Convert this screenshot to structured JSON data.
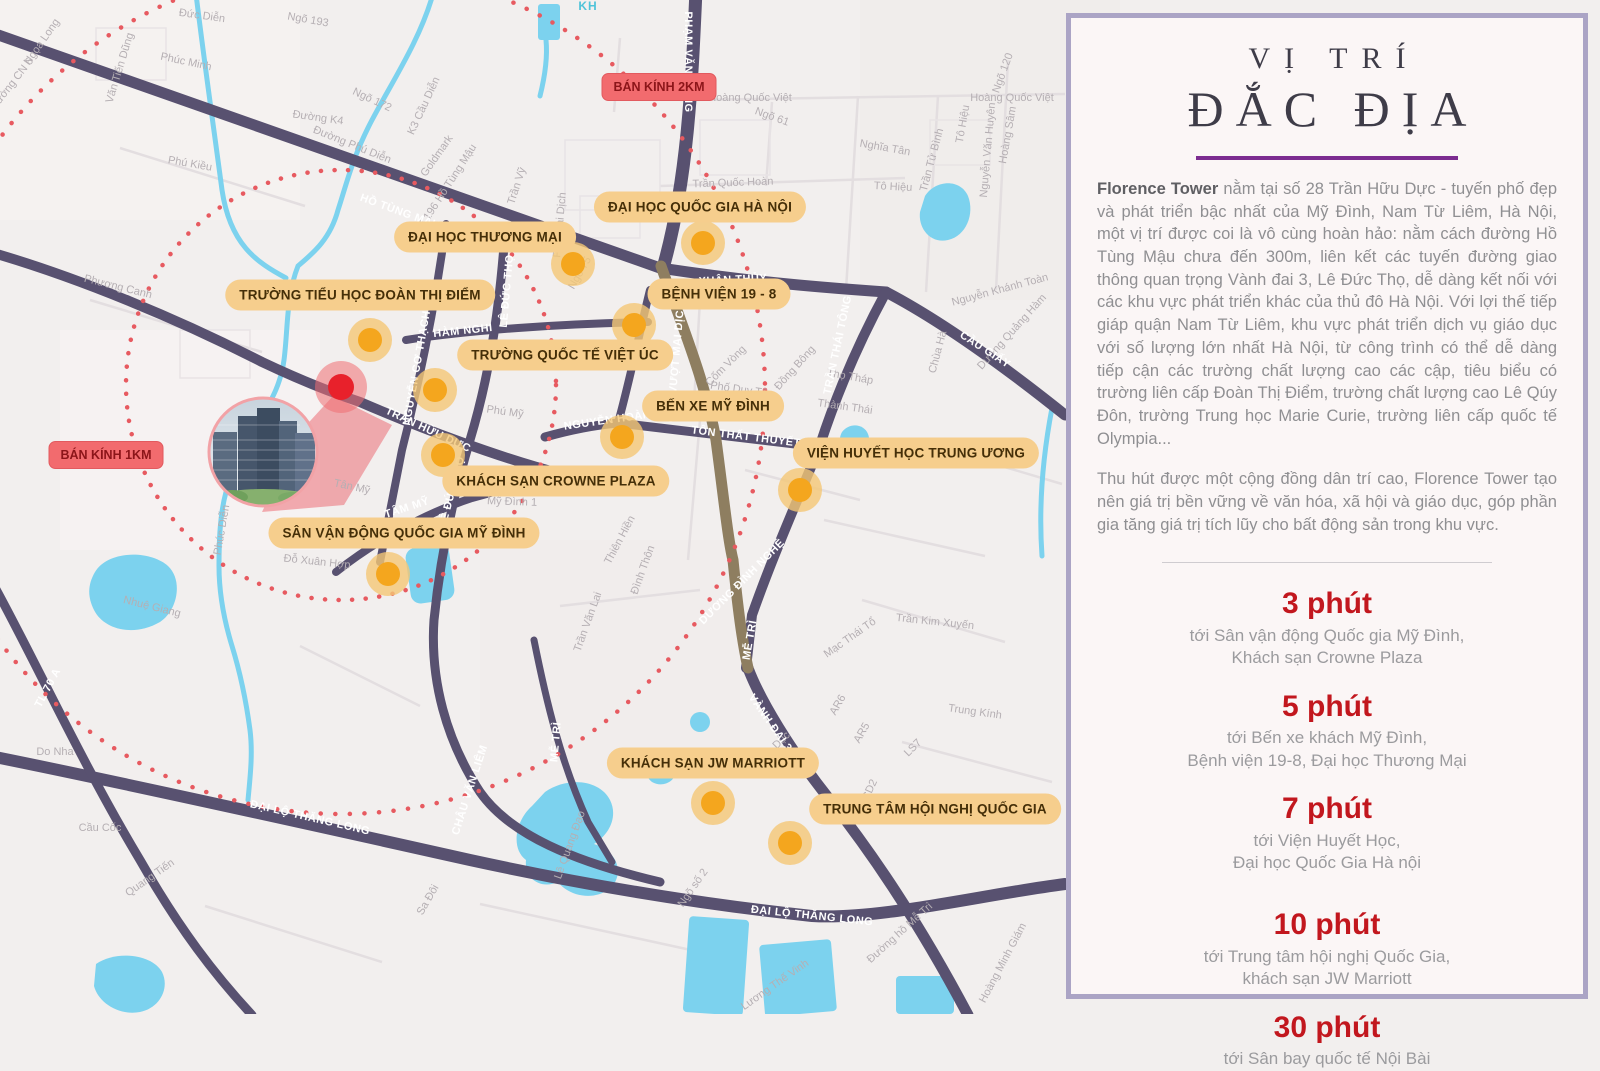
{
  "colors": {
    "road_purple": "#585170",
    "road_brown": "#8E7E60",
    "water": "#7CD2EE",
    "poi_bg": "#F6CE8D",
    "poi_text": "#452F08",
    "radius_bg": "#F26B6E",
    "radius_text": "#8C1519",
    "marker_core": "#F4A61E",
    "marker_halo": "#F4C776",
    "project_red": "#E8212B",
    "dotted_circle": "#E75A60",
    "panel_border": "#ABA4C5",
    "panel_bg": "#FBF6F6",
    "accent_purple": "#7C2C90",
    "time_red": "#C2171E",
    "body_text": "#8F8F92"
  },
  "map": {
    "radius_labels": [
      {
        "t": "BÁN KÍNH 2KM"
      },
      {
        "t": "BÁN KÍNH 1KM"
      }
    ],
    "pois": [
      {
        "t": "ĐẠI HỌC QUỐC GIA HÀ NỘI"
      },
      {
        "t": "ĐẠI HỌC THƯƠNG MẠI"
      },
      {
        "t": "TRƯỜNG TIỂU HỌC ĐOÀN THỊ ĐIỂM"
      },
      {
        "t": "BỆNH VIỆN 19 - 8"
      },
      {
        "t": "TRƯỜNG QUỐC TẾ VIỆT ÚC"
      },
      {
        "t": "BẾN XE MỸ ĐÌNH"
      },
      {
        "t": "KHÁCH SẠN CROWNE PLAZA"
      },
      {
        "t": "VIỆN HUYẾT HỌC TRUNG ƯƠNG"
      },
      {
        "t": "SÂN VẬN ĐỘNG QUỐC GIA MỸ ĐÌNH"
      },
      {
        "t": "KHÁCH SẠN JW MARRIOTT"
      },
      {
        "t": "TRUNG TÂM HỘI NGHỊ QUỐC GIA"
      }
    ],
    "roads_labels": [
      {
        "t": "HỒ TÙNG MẬU"
      },
      {
        "t": "PHẠM VĂN ĐỒNG"
      },
      {
        "t": "XUÂN THỦY"
      },
      {
        "t": "CẦU GIẤY"
      },
      {
        "t": "TRẦN THÁI TÔNG"
      },
      {
        "t": "CẦU VƯỢT MAI DỊCH"
      },
      {
        "t": "TÔN THẤT THUYẾT"
      },
      {
        "t": "LÊ ĐỨC THỌ"
      },
      {
        "t": "LÊ ĐỨC THỌ"
      },
      {
        "t": "TRẦN HỮU DỰC"
      },
      {
        "t": "TÂM MỸ"
      },
      {
        "t": "NGUYỄN CƠ THẠCH"
      },
      {
        "t": "HÀM NGHI"
      },
      {
        "t": "NGUYỄN HOÀNG"
      },
      {
        "t": "ĐẠI LỘ THĂNG LONG"
      },
      {
        "t": "ĐẠI LỘ THĂNG LONG"
      },
      {
        "t": "VÀNH ĐAI 3"
      },
      {
        "t": "MỄ TRÌ"
      },
      {
        "t": "MỄ TRÌ"
      },
      {
        "t": "DƯƠNG ĐÌNH NGHỆ"
      },
      {
        "t": "CHÂU VĂN LIÊM"
      },
      {
        "t": "TL 70 A"
      }
    ],
    "streets": [
      {
        "t": "Ngọa Long"
      },
      {
        "t": "Văn Tiến Dũng"
      },
      {
        "t": "Đức Diễn"
      },
      {
        "t": "Phúc Minh"
      },
      {
        "t": "Ngõ 193"
      },
      {
        "t": "Đường K4"
      },
      {
        "t": "Ngõ 172"
      },
      {
        "t": "Đường Phú Diễn"
      },
      {
        "t": "K3 Cầu Diễn"
      },
      {
        "t": "Phú Kiều"
      },
      {
        "t": "Đường CN 6"
      },
      {
        "t": "Phương Canh"
      },
      {
        "t": "Goldmark"
      },
      {
        "t": "Ngõ 196 Hồ Tùng Mậu"
      },
      {
        "t": "Trần Vỹ"
      },
      {
        "t": "Phố Mai Dịch"
      },
      {
        "t": "Ngõ 75"
      },
      {
        "t": "Hoàng Quốc Việt"
      },
      {
        "t": "Hoàng Quốc Việt"
      },
      {
        "t": "Ngõ 61"
      },
      {
        "t": "Ngõ 120"
      },
      {
        "t": "Trần Quốc Hoàn"
      },
      {
        "t": "Nghĩa Tân"
      },
      {
        "t": "Tô Hiệu"
      },
      {
        "t": "Tô Hiệu"
      },
      {
        "t": "Trần Tử Bình"
      },
      {
        "t": "Nguyễn Văn Huyên"
      },
      {
        "t": "Hoàng Sâm"
      },
      {
        "t": "Nguyễn Khánh Toàn"
      },
      {
        "t": "Dương Quảng Hàm"
      },
      {
        "t": "Chùa Hà"
      },
      {
        "t": "Đồng Bông"
      },
      {
        "t": "Thọ Tháp"
      },
      {
        "t": "Thành Thái"
      },
      {
        "t": "Phố Duy Tân"
      },
      {
        "t": "Cốm Vòng"
      },
      {
        "t": "Phú Mỹ"
      },
      {
        "t": "Tân Mỹ"
      },
      {
        "t": "Mỹ Đình 1"
      },
      {
        "t": "Đỗ Xuân Hợp"
      },
      {
        "t": "Phúc Diễn"
      },
      {
        "t": "Nhuệ Giang"
      },
      {
        "t": "Thiên Hiền"
      },
      {
        "t": "Đình Thôn"
      },
      {
        "t": "Trần Văn Lai"
      },
      {
        "t": "Trần Kim Xuyến"
      },
      {
        "t": "Mạc Thái Tổ"
      },
      {
        "t": "Trung Kính"
      },
      {
        "t": "AR6"
      },
      {
        "t": "AR5"
      },
      {
        "t": "LS7"
      },
      {
        "t": "CD2"
      },
      {
        "t": "Đỗ Đức Dục"
      },
      {
        "t": "Ngõ số 2"
      },
      {
        "t": "Lương Thế Vinh"
      },
      {
        "t": "Đường hồ Mễ Trì"
      },
      {
        "t": "Hoàng Minh Giám"
      },
      {
        "t": "Lê Quang Đạo"
      },
      {
        "t": "Do Nha"
      },
      {
        "t": "Cầu Cốc"
      },
      {
        "t": "Quang Tiến"
      },
      {
        "t": "Sa Đôi"
      }
    ],
    "water_labels": [
      {
        "t": "KH"
      }
    ]
  },
  "panel": {
    "title_small": "VỊ TRÍ",
    "title_large": "ĐẮC ĐỊA",
    "brand": "Florence Tower",
    "paragraph1": " nằm tại số 28 Trần Hữu Dực - tuyến phố đẹp và phát triển bậc nhất của Mỹ Đình, Nam Từ Liêm, Hà Nội, một vị trí được coi là vô cùng hoàn hảo: nằm cách đường Hồ Tùng Mậu chưa đến 300m, liên kết các tuyến đường giao thông quan trọng Vành đai 3, Lê Đức Thọ, dễ dàng kết nối với các khu vực phát triển khác của thủ đô Hà Nội. Với lợi thế tiếp giáp quận Nam Từ Liêm, khu vực phát triển dịch vụ giáo dục với số lượng lớn nhất Hà Nội, từ công trình có thể dễ dàng tiếp cận các trường chất lượng cao các cập, tiêu biểu có trường liên cấp Đoàn Thị Điểm, trường chất lượng cao Lê Qúy Đôn, trường Trung học Marie Curie, trường liên cấp quốc tế Olympia...",
    "paragraph2": "Thu hút được một cộng đồng dân trí cao, Florence Tower tạo nên giá trị bền vững về văn hóa, xã hội và giáo dục, góp phần gia tăng giá trị tích lũy cho bất động sản trong khu vực.",
    "times": [
      {
        "time": "3 phút",
        "line1": "tới Sân vận động Quốc gia Mỹ Đình,",
        "line2": "Khách sạn Crowne Plaza"
      },
      {
        "time": "5 phút",
        "line1": "tới Bến xe khách Mỹ Đình,",
        "line2": "Bệnh viện 19-8, Đại học Thương Mại"
      },
      {
        "time": "7 phút",
        "line1": "tới Viện Huyết Học,",
        "line2": "Đại học Quốc Gia Hà nội"
      },
      {
        "time": "10 phút",
        "line1": "tới Trung tâm hội nghị Quốc Gia,",
        "line2": "khách sạn JW Marriott"
      },
      {
        "time": "30 phút",
        "line1": "tới Sân bay quốc tế Nội Bài",
        "line2": ""
      }
    ]
  }
}
